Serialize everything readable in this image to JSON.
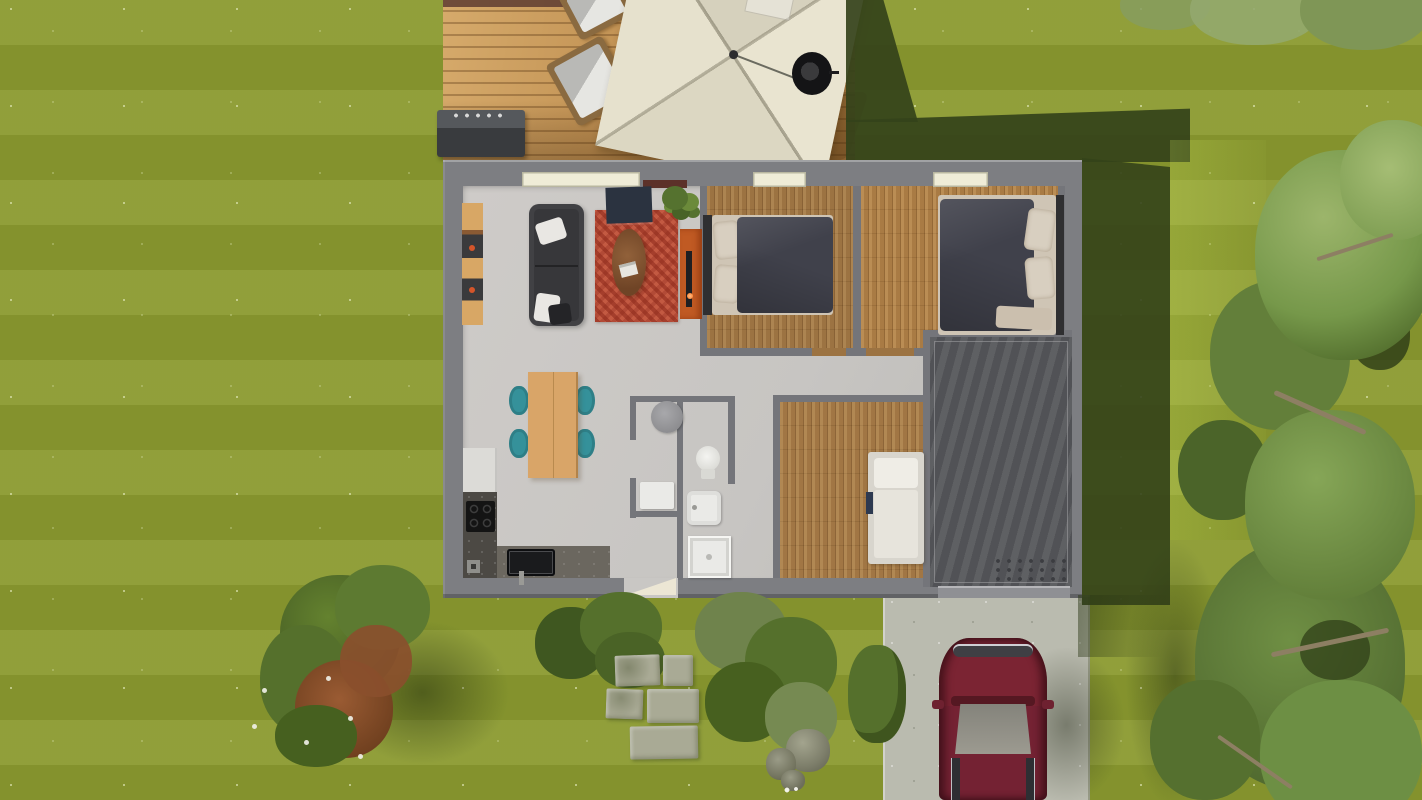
{
  "scene": {
    "type": "3D top-down exterior render of a single-storey house plan",
    "width_px": 1422,
    "height_px": 800,
    "rooms": [
      "living-dining-kitchen",
      "bedroom-1",
      "bedroom-2",
      "bedroom-3",
      "wc",
      "bathroom",
      "garage"
    ]
  },
  "labels": {
    "deck": "wooden terrace",
    "parasol": "square patio umbrella",
    "grill": "barbecue grill",
    "lounger": "deck lounge chair",
    "firepit": "round fire pit",
    "sofa": "dark sofa",
    "rug": "red patterned rug",
    "coffee_table": "oval coffee table",
    "tv_cabinet": "orange TV sideboard",
    "shelf": "wall shelving unit",
    "plant": "green plant",
    "tv_board": "navy wall screen",
    "dining_table": "wooden dining table",
    "chair": "teal dining chair",
    "fridge": "refrigerator",
    "cooktop": "black cooktop",
    "counter": "kitchen counter",
    "sink": "kitchen sink",
    "wc_basin": "round washbasin",
    "wc_cabinet": "bathroom cabinet",
    "toilet": "toilet",
    "bath_sink": "washbasin",
    "shower": "shower tray",
    "bed_double": "double bed",
    "bed_single": "single bed",
    "garage": "garage floor",
    "driveway": "concrete driveway",
    "car": "dark red car",
    "stone": "stepping stone",
    "rock": "garden rock",
    "bush": "flowering shrub",
    "shrub": "garden shrub",
    "tree": "large tree",
    "door": "entrance door",
    "window": "window"
  },
  "colors": {
    "grass": "#8b9a30",
    "grass_light": "#9ab23c",
    "shadow_green": "#34421a",
    "deck_wood": "#c79a5d",
    "wall": "#7d7e82",
    "interior_wall": "#74757a",
    "floor": "#c9c7c4",
    "wood_floor": "#9c7342",
    "garage_floor": "#56575b",
    "driveway": "#babbaf",
    "car_body": "#7b2433",
    "car_glass": "#8f8d83",
    "rug": "#b24a36",
    "sofa": "#37373a",
    "pillow": "#e9e7e3",
    "mattress": "#cfc5b5",
    "duvet": "#40414b",
    "table_wood": "#d9a568",
    "chair_teal": "#35919a",
    "cabinet_orange": "#c05a23",
    "navy": "#2b3340",
    "window_cream": "#efecd7",
    "door_cream": "#ece6d4",
    "fixture_white": "#eaeae7",
    "parasol_cream": "#e4dfcb",
    "counter_dark": "#4c4944",
    "stone": "#a9aa95",
    "rock": "#8f907c",
    "tree_green": "#76984a",
    "bush_rust": "#975732",
    "flower_white": "#f2f2ea"
  }
}
